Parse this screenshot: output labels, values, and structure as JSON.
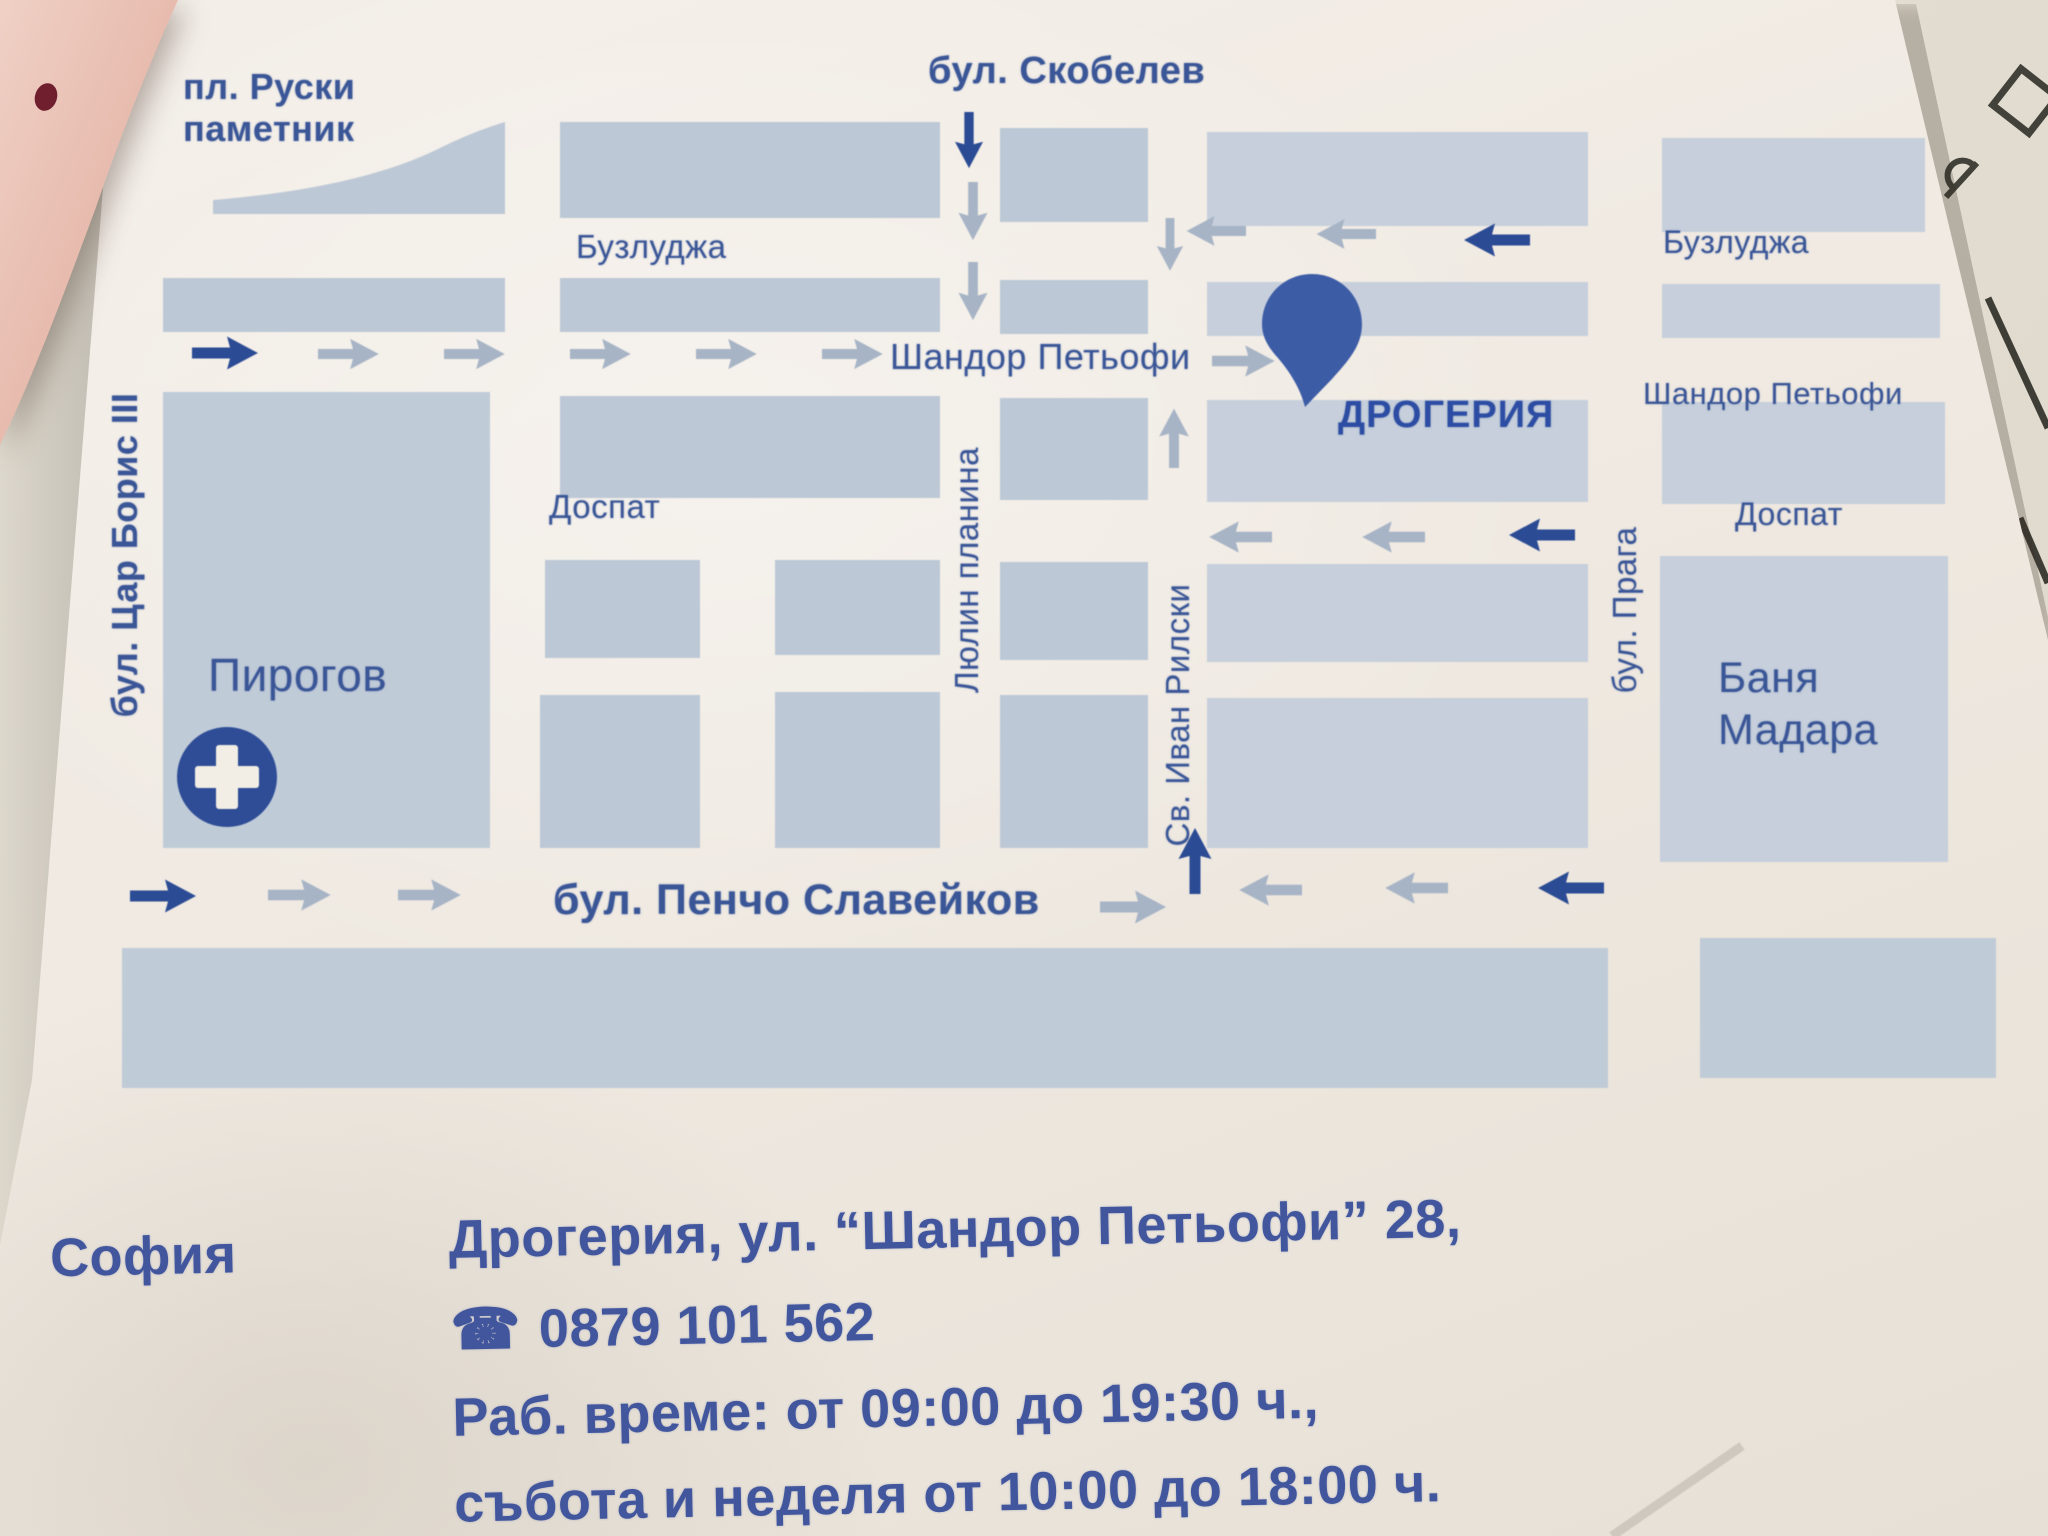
{
  "map": {
    "labels": {
      "ruski_line1": "пл. Руски",
      "ruski_line2": "паметник",
      "skobelev": "бул. Скобелев",
      "buzludzha": "Бузлуджа",
      "shandor_petyofi": "Шандор Петьофи",
      "drogeria": "ДРОГЕРИЯ",
      "dospat": "Доспат",
      "tsar_boris": "бул. Цар Борис III",
      "lyulin_planina": "Люлин планина",
      "sv_ivan_rilski": "Св. Иван Рилски",
      "praga": "бул. Прага",
      "pirogov": "Пирогов",
      "banya_line1": "Баня",
      "banya_line2": "Мадара",
      "pencho_slaveykov": "бул. Пенчо Славейков"
    },
    "colors": {
      "block": "#bdc8d6",
      "paper": "#efe9e1",
      "dark_blue": "#2e4d96",
      "gray_arrow": "#a7b4c6",
      "label_blue": "#3a5697",
      "pin_blue": "#3d5ca6"
    }
  },
  "info": {
    "city": "София",
    "address": "Дрогерия, ул. “Шандор Петьофи” 28,",
    "phone_icon": "☎",
    "phone": "0879 101 562",
    "hours_line1": "Раб. време: от 09:00 до 19:30 ч.,",
    "hours_line2": "събота и неделя от 10:00 до 18:00 ч."
  }
}
